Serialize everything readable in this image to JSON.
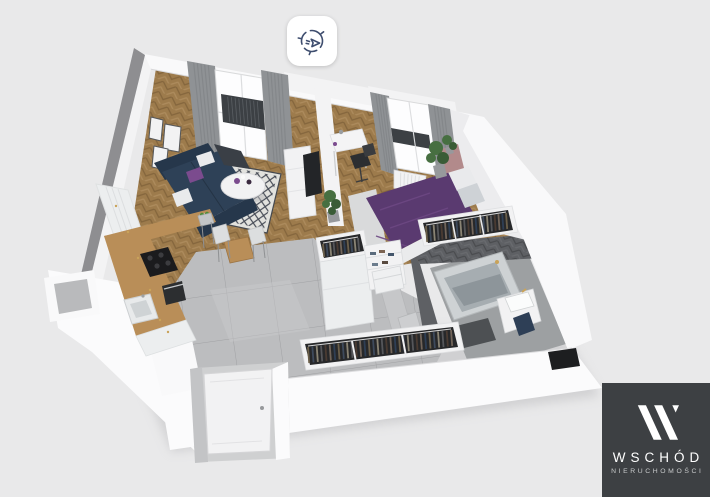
{
  "canvas": {
    "width": 710,
    "height": 497,
    "background": "#e9e9ea"
  },
  "viewer": {
    "rotate_button": {
      "icon": "rotate-compass-icon",
      "icon_color": "#3e4d6e",
      "background": "#ffffff"
    }
  },
  "branding": {
    "name": "WSCHÓD",
    "tagline": "NIERUCHOMOŚCI",
    "mark": "W-slash-logo",
    "background": "#3d4043",
    "text_color": "#ffffff",
    "tagline_color": "#c9cbcc"
  },
  "floorplan": {
    "view": "3d-isometric-apartment",
    "rooms": [
      "living-room",
      "kitchen",
      "dining-area",
      "bedroom",
      "wardrobe-hall",
      "bathroom",
      "entrance"
    ],
    "palette": {
      "shadow": "#b9b9bc",
      "wallTop": "#f9f9fa",
      "wallLight": "#f3f3f4",
      "wallInner": "#ececee",
      "wallDark": "#8e8e91",
      "wallFace": "#fbfbfc",
      "wood": "#9d7b4c",
      "tile": "#bcbdbf",
      "tileLight": "#c9cacb",
      "bathWall": "#5e6064",
      "bathFloor": "#9da0a2",
      "matDark": "#4d5053",
      "tubOuter": "#ced2d4",
      "tubInner": "#a6adb1",
      "white": "#f2f2f3",
      "curtain": "#8f9295",
      "curtainDark": "#7c7f82",
      "glass": "#fdfdfe",
      "railing": "#3c4044",
      "sofaNavy": "#2e4157",
      "sofaDark": "#26374b",
      "charcoal": "#3a3f46",
      "pillowWhite": "#e9eaec",
      "accentPurple": "#7b4b8e",
      "rugBase": "#e2e2de",
      "bedPurple": "#5a3a70",
      "bedPurpleHi": "#6d4883",
      "pillowGray": "#ced2d6",
      "bedBase": "#eaebec",
      "nightPink": "#b28a8b",
      "clothesDark": "#27282a",
      "counterWood": "#b98e58",
      "cabinet": "#eceeef",
      "cooktop": "#1b1b1d",
      "oven": "#2c2e30",
      "stool": "#c2c5c7",
      "chairWhite": "#dcdedf",
      "plant": "#476f41",
      "plantDark": "#3a5c36",
      "tv": "#232528",
      "deskWhite": "#f4f4f5",
      "chairBlack": "#2c2e31",
      "gold": "#c9a35a",
      "doorGray": "#c6c7c9",
      "alcoveGray": "#c3c4c6",
      "alcoveFloor": "#cfd0d1",
      "navyTowel": "#2e3f56",
      "doormat": "#1d1e20"
    }
  }
}
